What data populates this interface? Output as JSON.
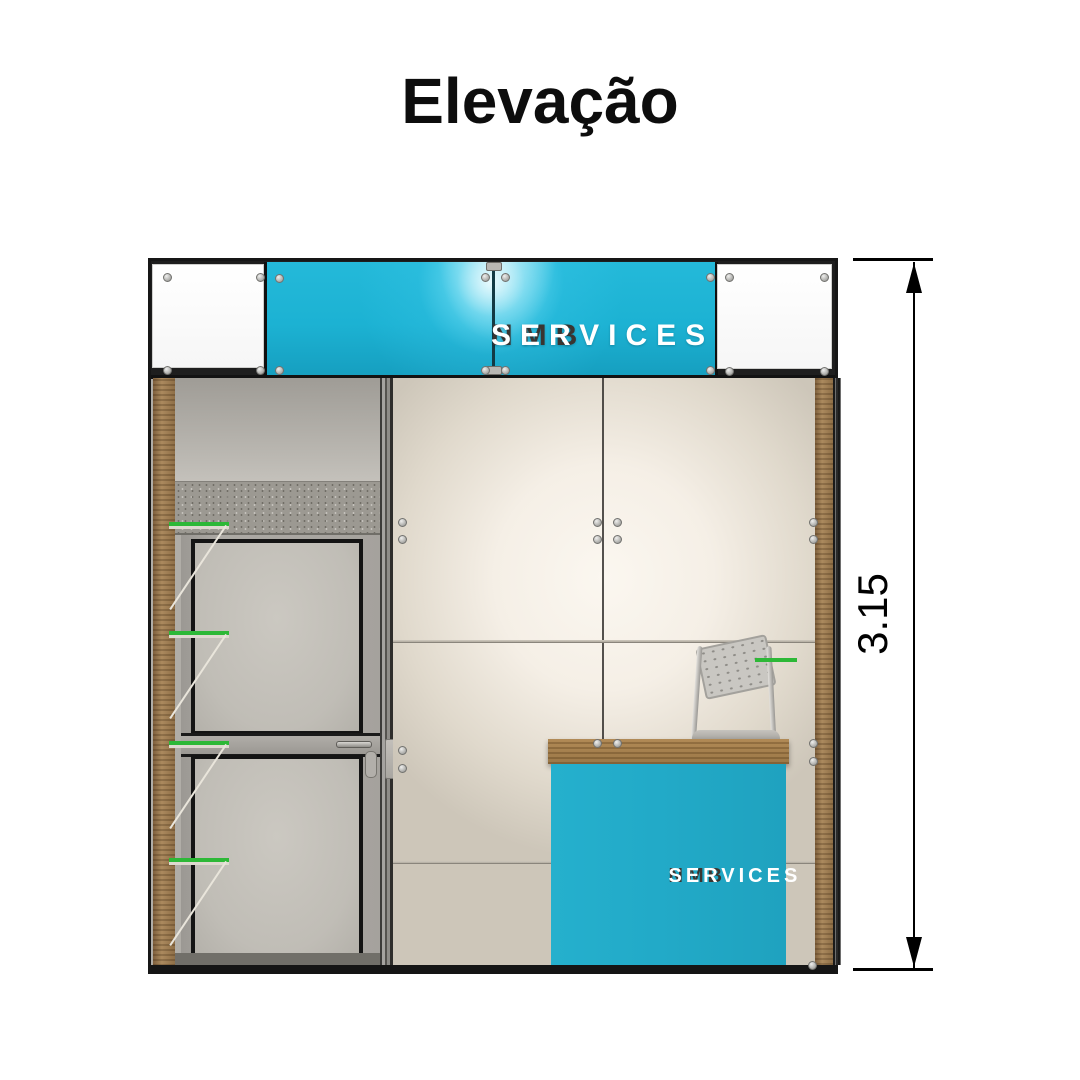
{
  "title": {
    "text": "Elevação"
  },
  "dimension": {
    "value": "3.15"
  },
  "header_banner": {
    "brand_bold": "NMB",
    "brand_light": "SERVICES"
  },
  "counter": {
    "brand_bold": "NMB",
    "brand_light": "SERVICES"
  },
  "colors": {
    "banner_cyan": "#1cb2d3",
    "counter_cyan": "#22aac8",
    "shelf_green": "#2db837",
    "wood": "#9a7950",
    "frame_dark": "#161616"
  }
}
